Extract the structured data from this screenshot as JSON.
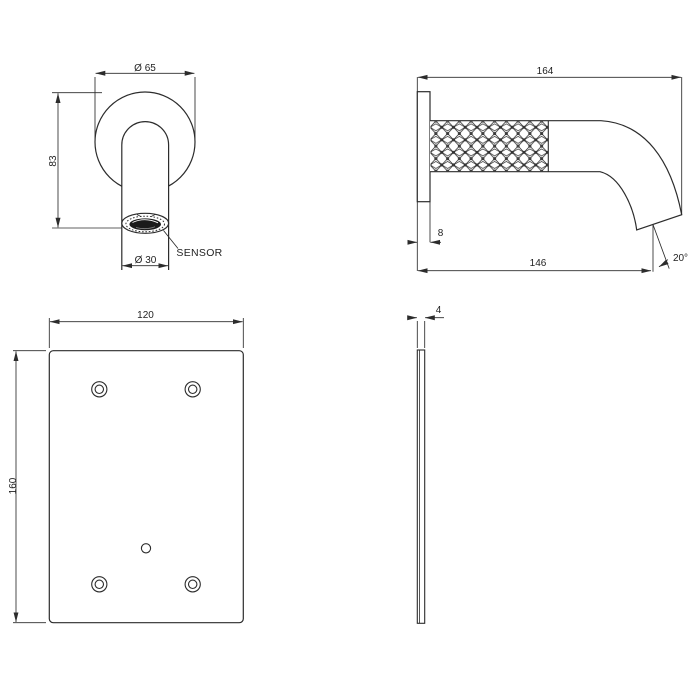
{
  "canvas": {
    "background": "#ffffff",
    "line_color": "#2c2c2c",
    "text_color": "#1f1f1f",
    "sensor_fill": "#1b1b1b"
  },
  "views": {
    "spout_front": {
      "flange_diameter": "Ø 65",
      "height": "83",
      "outlet_diameter": "Ø 30",
      "sensor": "SENSOR"
    },
    "spout_side": {
      "total_length": "164",
      "plate_thickness": "8",
      "projection": "146",
      "outlet_angle": "20°"
    },
    "backplate_front": {
      "width": "120",
      "height": "160"
    },
    "backplate_side": {
      "thickness": "4"
    }
  }
}
